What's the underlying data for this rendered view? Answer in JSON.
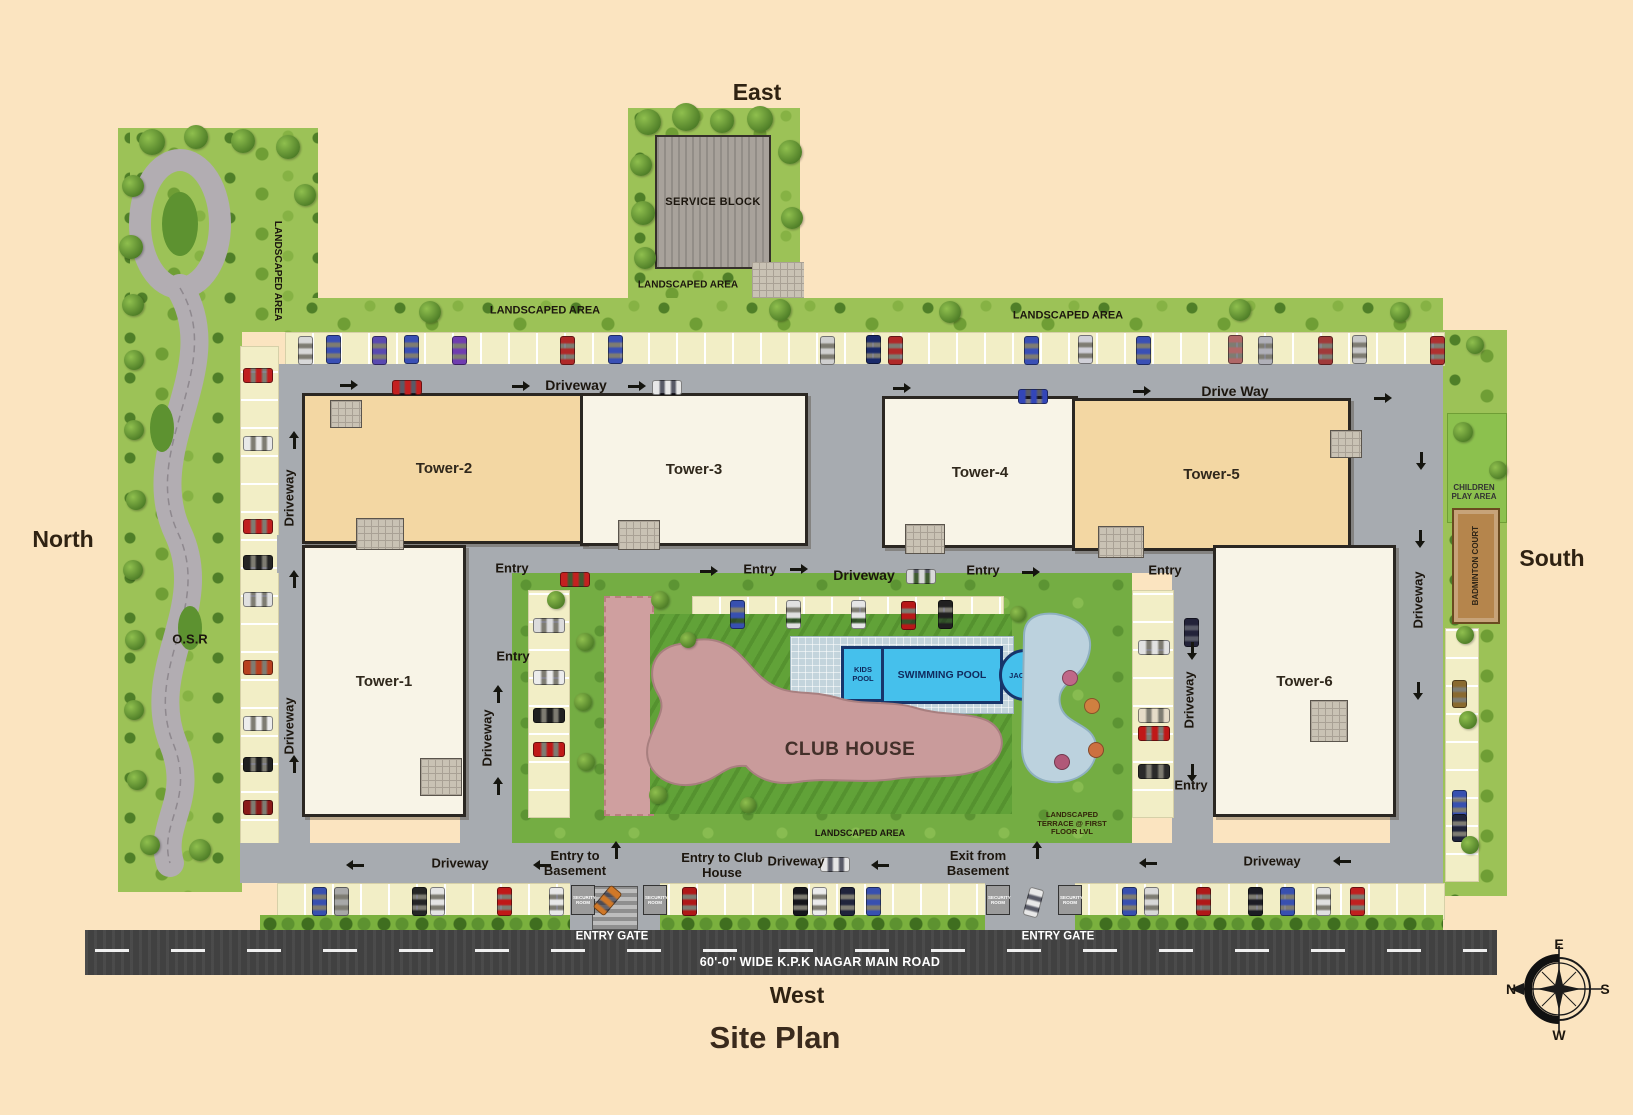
{
  "title": "Site Plan",
  "directions": {
    "top": "East",
    "bottom": "West",
    "left": "North",
    "right": "South"
  },
  "compass": {
    "top": "E",
    "right": "S",
    "bottom": "W",
    "left": "N"
  },
  "towers": [
    {
      "label": "Tower-1"
    },
    {
      "label": "Tower-2"
    },
    {
      "label": "Tower-3"
    },
    {
      "label": "Tower-4"
    },
    {
      "label": "Tower-5"
    },
    {
      "label": "Tower-6"
    }
  ],
  "areas": {
    "service_block": "SERVICE BLOCK",
    "landscaped_area": "LANDSCAPED AREA",
    "osr": "O.S.R",
    "club_house": "CLUB HOUSE",
    "kids_pool": "KIDS POOL",
    "swimming_pool": "SWIMMING POOL",
    "jacuzzi": "JACUZZI",
    "children_play_area": "CHILDREN PLAY AREA",
    "badminton_court": "BADMINTON COURT",
    "landscaped_terrace": "LANDSCAPED TERRACE @ FIRST FLOOR LVL",
    "security_room": "SECURITY ROOM"
  },
  "roads": {
    "driveway": "Driveway",
    "drive_way": "Drive Way",
    "entry": "Entry",
    "entry_to_basement": "Entry to Basement",
    "entry_to_club_house": "Entry to Club House",
    "exit_from_basement": "Exit from Basement",
    "entry_gate": "ENTRY GATE",
    "main_road": "60'-0'' WIDE K.P.K NAGAR MAIN ROAD"
  },
  "colors": {
    "background": "#fbe4c0",
    "green": "#9cc257",
    "driveway": "#a7abb0",
    "road": "#414141",
    "parking": "#f2eec6",
    "tower_tan": "#f3d7a3",
    "tower_cream": "#f8f4e7",
    "pool": "#45c0ec",
    "club_house": "#c99b9b",
    "terrace_tile": "#bcd2de",
    "badminton": "#b5854c"
  }
}
